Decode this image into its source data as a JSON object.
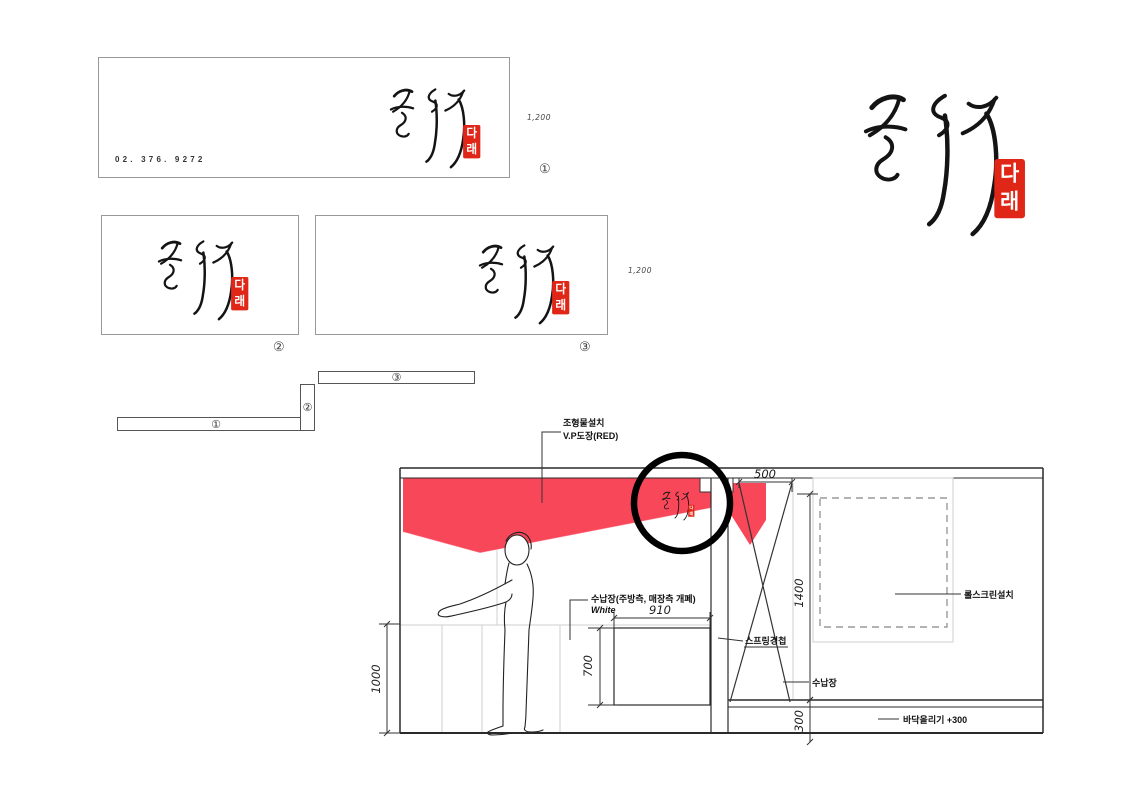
{
  "signs": {
    "sign1": {
      "phone": "02. 376. 9272",
      "scale_label": "1,200",
      "number_label": "①"
    },
    "sign2": {
      "number_label": "②"
    },
    "sign3": {
      "scale_label": "1,200",
      "number_label": "③"
    }
  },
  "plan_parts": {
    "label1": "①",
    "label2": "②",
    "label3": "③"
  },
  "logo": {
    "calligraphy_text": "칼국수",
    "seal_top": "다",
    "seal_bottom": "래"
  },
  "elevation": {
    "annotations": {
      "sculpture_line1": "조형물설치",
      "sculpture_line2": "V.P도장(RED)",
      "counter_cabinet_line1": "수납장(주방측, 매장측 개폐)",
      "counter_cabinet_line2": "White",
      "spring_hinge": "스프링경첩",
      "storage": "수납장",
      "roll_screen": "롤스크린설치",
      "floor_raise": "바닥올리기 +300"
    },
    "dimensions": {
      "width_500": "500",
      "height_1400": "1400",
      "width_910": "910",
      "height_700": "700",
      "height_1000": "1000",
      "height_300": "300"
    }
  },
  "colors": {
    "sculpture_red": "#f9475a",
    "seal_red": "#e02616"
  }
}
